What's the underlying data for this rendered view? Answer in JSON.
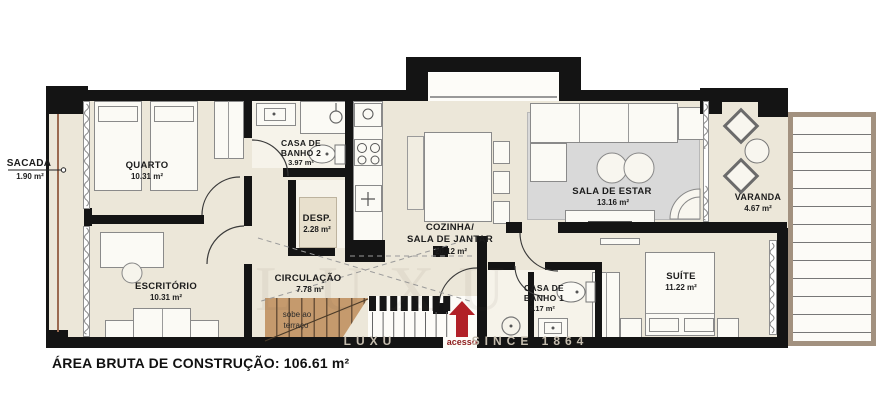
{
  "rooms": {
    "sacada": {
      "name": "SACADA",
      "area": "1.90 m²"
    },
    "quarto": {
      "name": "QUARTO",
      "area": "10.31 m²"
    },
    "banho2": {
      "name1": "CASA DE",
      "name2": "BANHO 2",
      "area": "3.97 m²"
    },
    "desp": {
      "name": "DESP.",
      "area": "2.28 m²"
    },
    "cozinha": {
      "name1": "COZINHA/",
      "name2": "SALA DE JANTAR",
      "area": "20.12 m²"
    },
    "sala": {
      "name": "SALA DE ESTAR",
      "area": "13.16 m²"
    },
    "varanda": {
      "name": "VARANDA",
      "area": "4.67 m²"
    },
    "escritorio": {
      "name": "ESCRITÓRIO",
      "area": "10.31 m²"
    },
    "circulacao": {
      "name": "CIRCULAÇÃO",
      "area": "7.78 m²"
    },
    "banho1": {
      "name1": "CASA DE",
      "name2": "BANHO 1",
      "area": "3.17 m²"
    },
    "suite": {
      "name": "SUÍTE",
      "area": "11.22 m²"
    }
  },
  "stairs": {
    "line1": "sobe ao",
    "line2": "terraço"
  },
  "entry": {
    "label": "acesso"
  },
  "footer": {
    "label": "ÁREA BRUTA DE CONSTRUÇÃO: 106.61 m²"
  },
  "watermark": {
    "fragment1": "LUXU",
    "fragment2": "SINCE 1864"
  },
  "colors": {
    "wall": "#141414",
    "floor": "#ece7d9",
    "rug": "#d9d9d9",
    "stair_wood": "#c59a6d",
    "accent_red": "#b12026"
  }
}
